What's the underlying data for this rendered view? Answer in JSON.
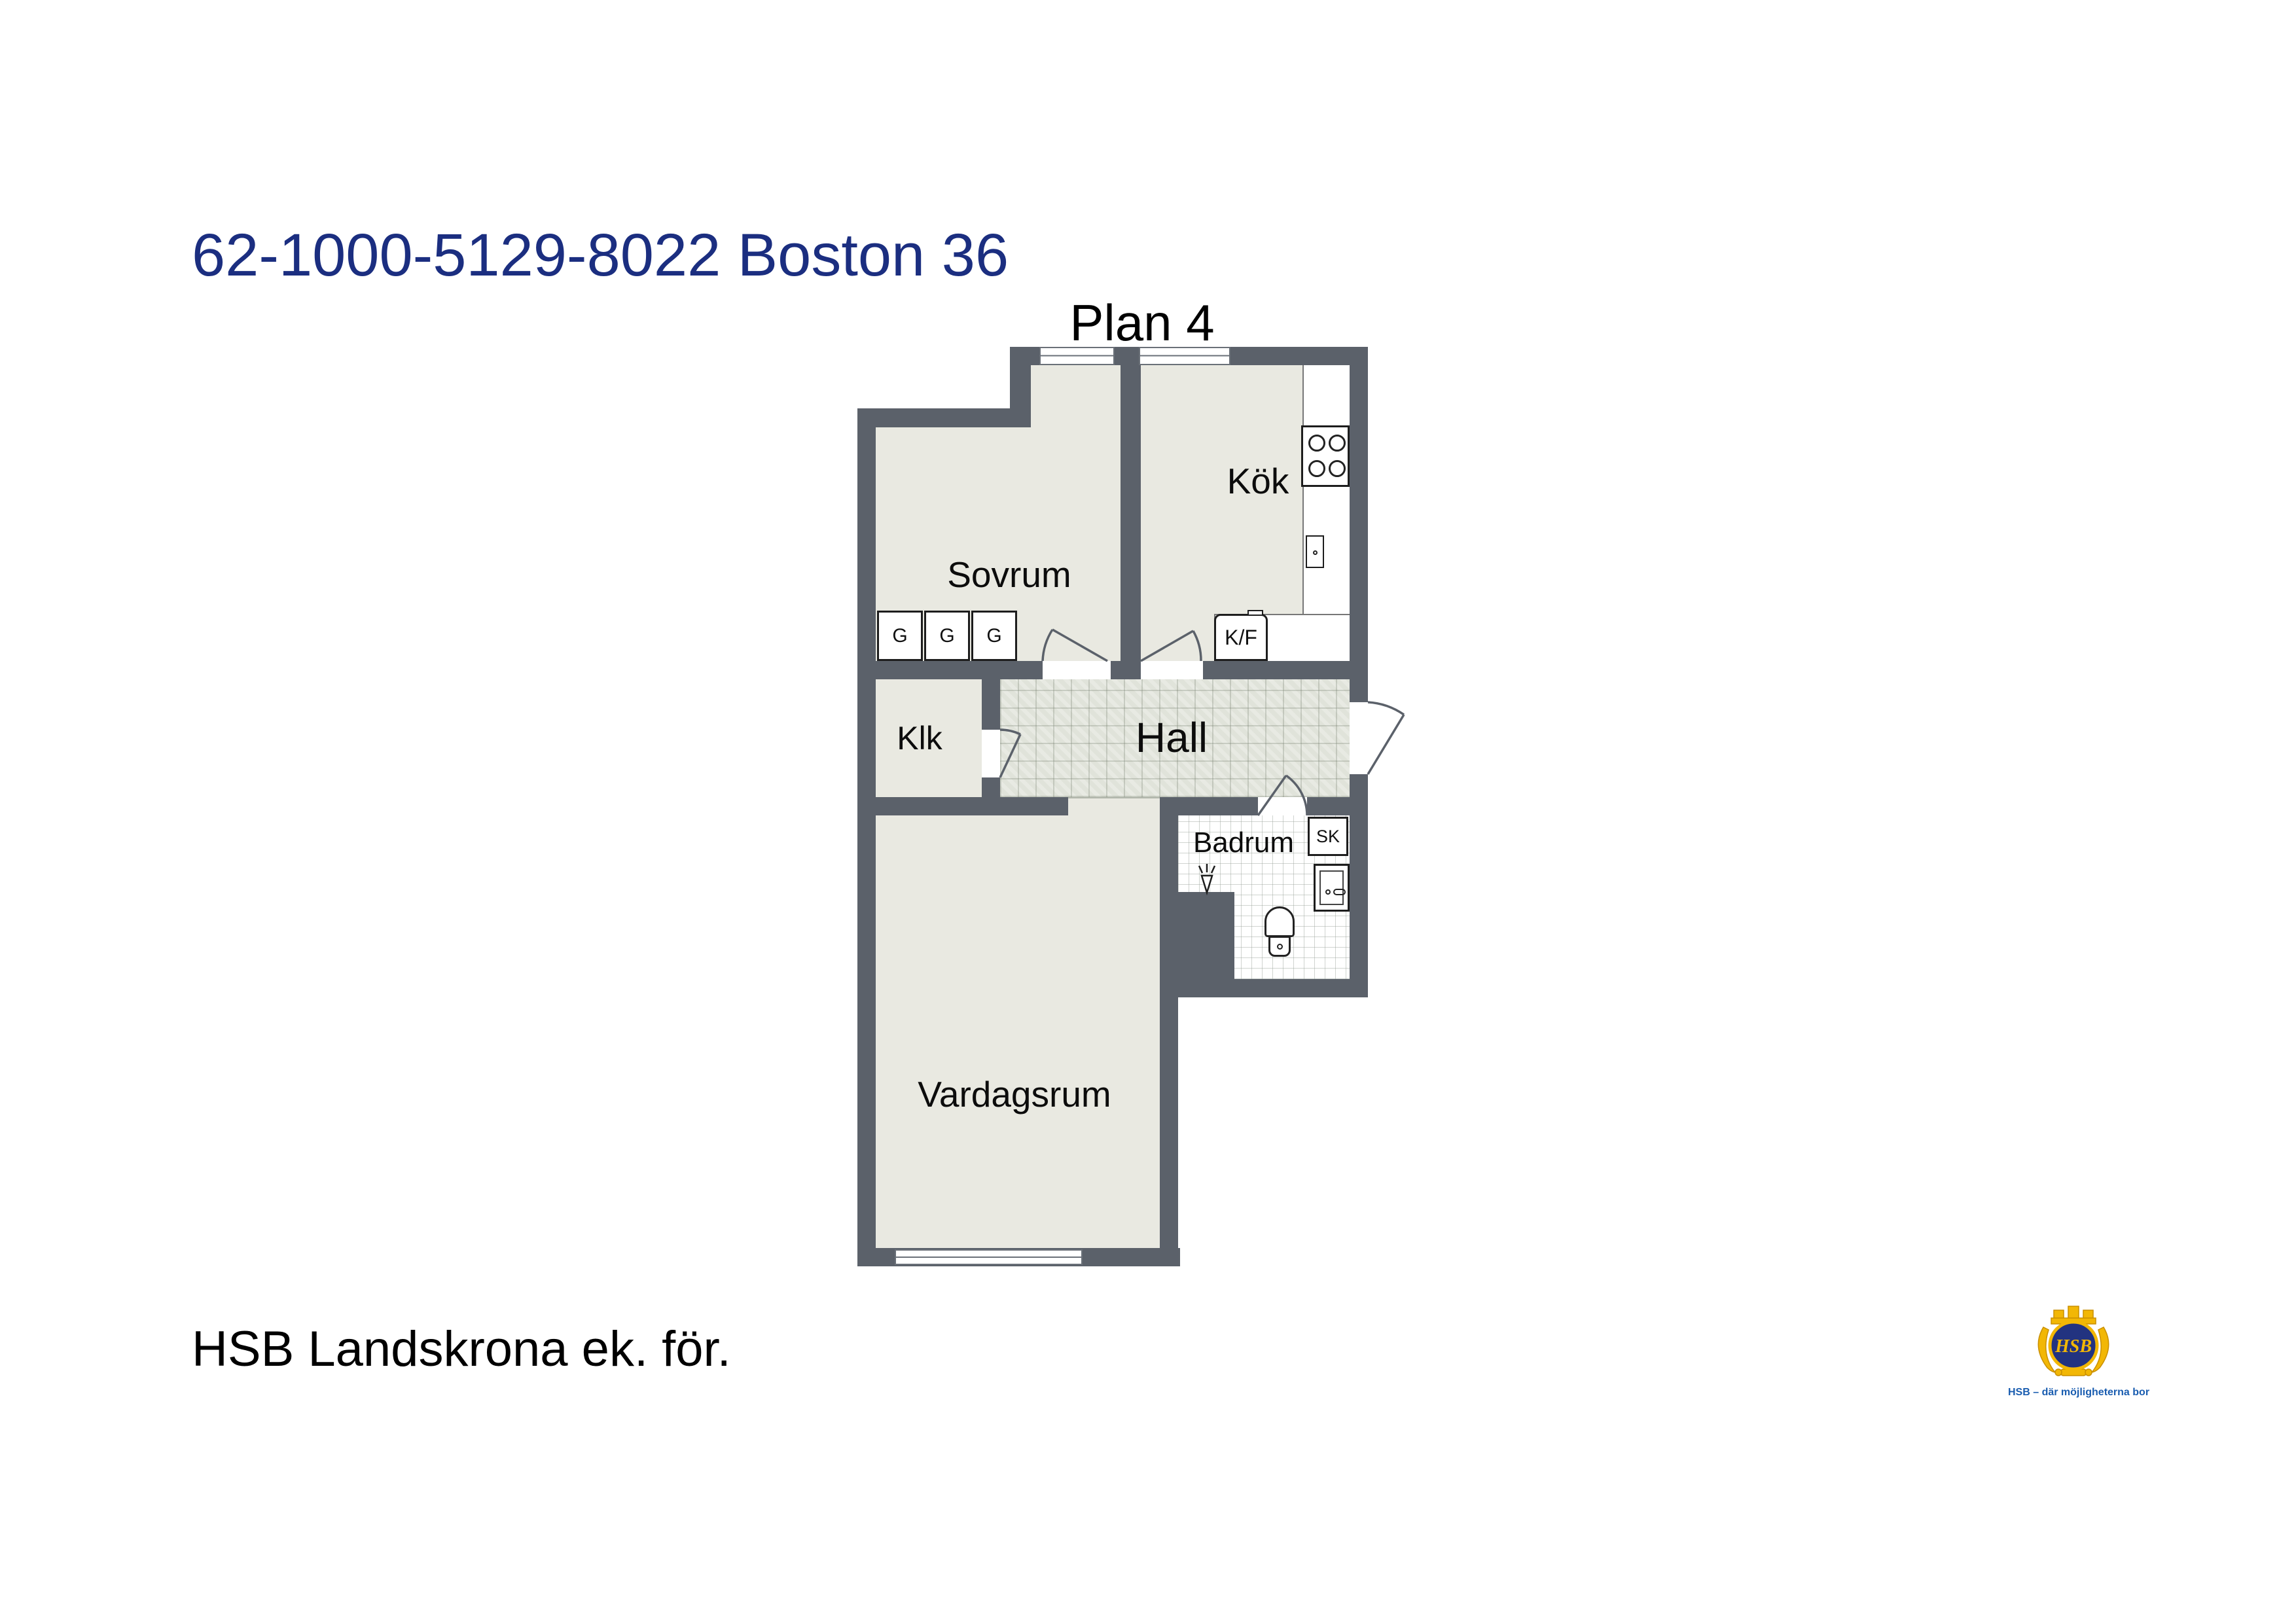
{
  "header": {
    "title": "62-1000-5129-8022 Boston 36",
    "plan_label": "Plan 4"
  },
  "rooms": {
    "bedroom": "Sovrum",
    "kitchen": "Kök",
    "closet": "Klk",
    "hall": "Hall",
    "bathroom": "Badrum",
    "living_room": "Vardagsrum"
  },
  "fixtures": {
    "wardrobes": [
      "G",
      "G",
      "G"
    ],
    "fridge_freezer": "K/F",
    "cabinet": "SK"
  },
  "footer": {
    "association": "HSB Landskrona ek. för."
  },
  "logo": {
    "monogram": "HSB",
    "tagline": "HSB – där möjligheterna bor"
  },
  "colors": {
    "title_blue": "#1b2e80",
    "wall_gray": "#5b616a",
    "floor_offwhite": "#e9e9e1",
    "hall_tile": "#e0e3da",
    "logo_gold": "#f2b705",
    "logo_circle_blue": "#223380",
    "tagline_blue": "#1a5db0"
  }
}
